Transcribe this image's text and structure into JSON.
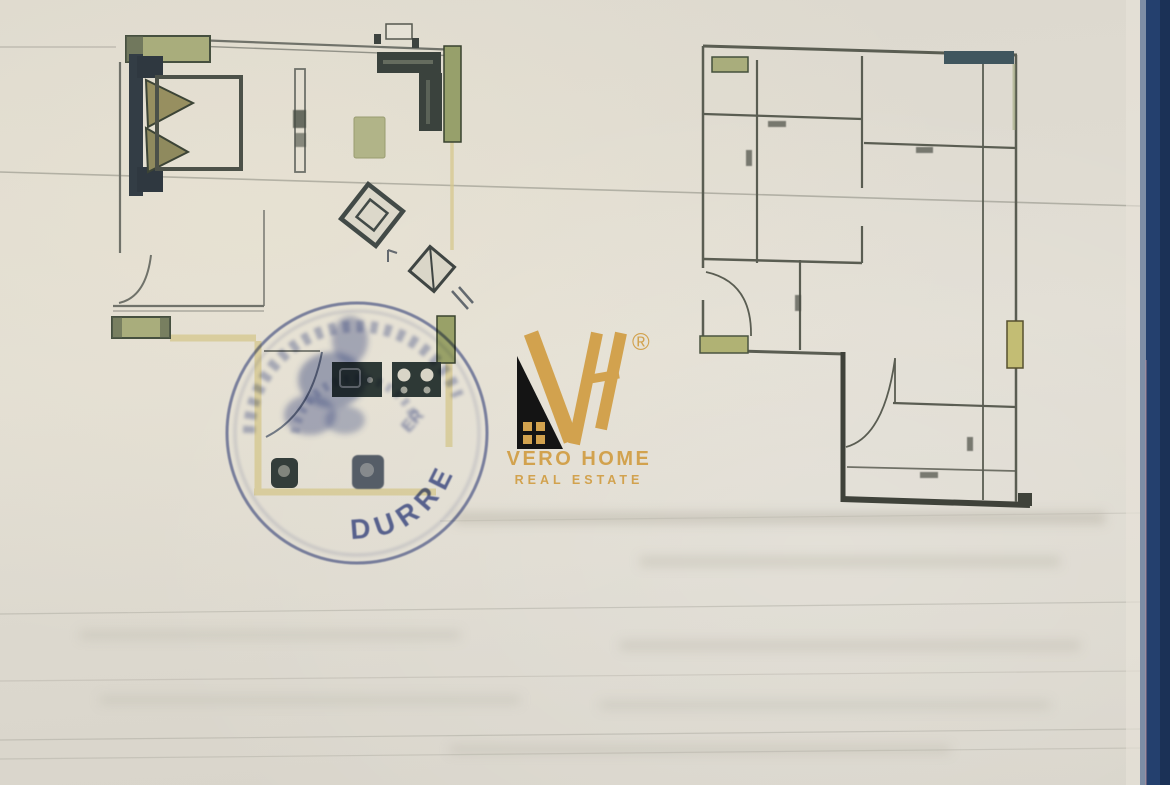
{
  "document": {
    "kind": "Scanned real-estate floor plan sheet",
    "paper_color": "#ded9cf",
    "ruled_line_color": "#8b8a80",
    "binder_edge_color": "#1d3760"
  },
  "left_plan": {
    "name": "Furnished apartment floor plan",
    "wall_highlight_color": "#d5c78c",
    "window_color": "#a9ad7c",
    "furniture_color": "#2e3936",
    "features": [
      "double bed with pillows",
      "nightstands",
      "wardrobe",
      "rug",
      "rotated square tables",
      "door swings",
      "kitchen sink",
      "stove with burners",
      "toilet",
      "washbasin",
      "windows"
    ]
  },
  "right_plan": {
    "name": "Apartment wall outline plan",
    "wall_color": "#5a5d52",
    "dimension_marks": "illegible small dimension labels",
    "features": [
      "room partitions",
      "door swings",
      "windows",
      "balcony strip"
    ]
  },
  "stamp": {
    "shape": "round",
    "color": "#4a5a9e",
    "city": "DURRES",
    "fragment": "ER"
  },
  "watermark": {
    "monogram": "VH",
    "registered": "®",
    "name": "VERO HOME",
    "tagline": "REAL ESTATE",
    "gold": "#d2a24e",
    "house_color": "#141414"
  }
}
